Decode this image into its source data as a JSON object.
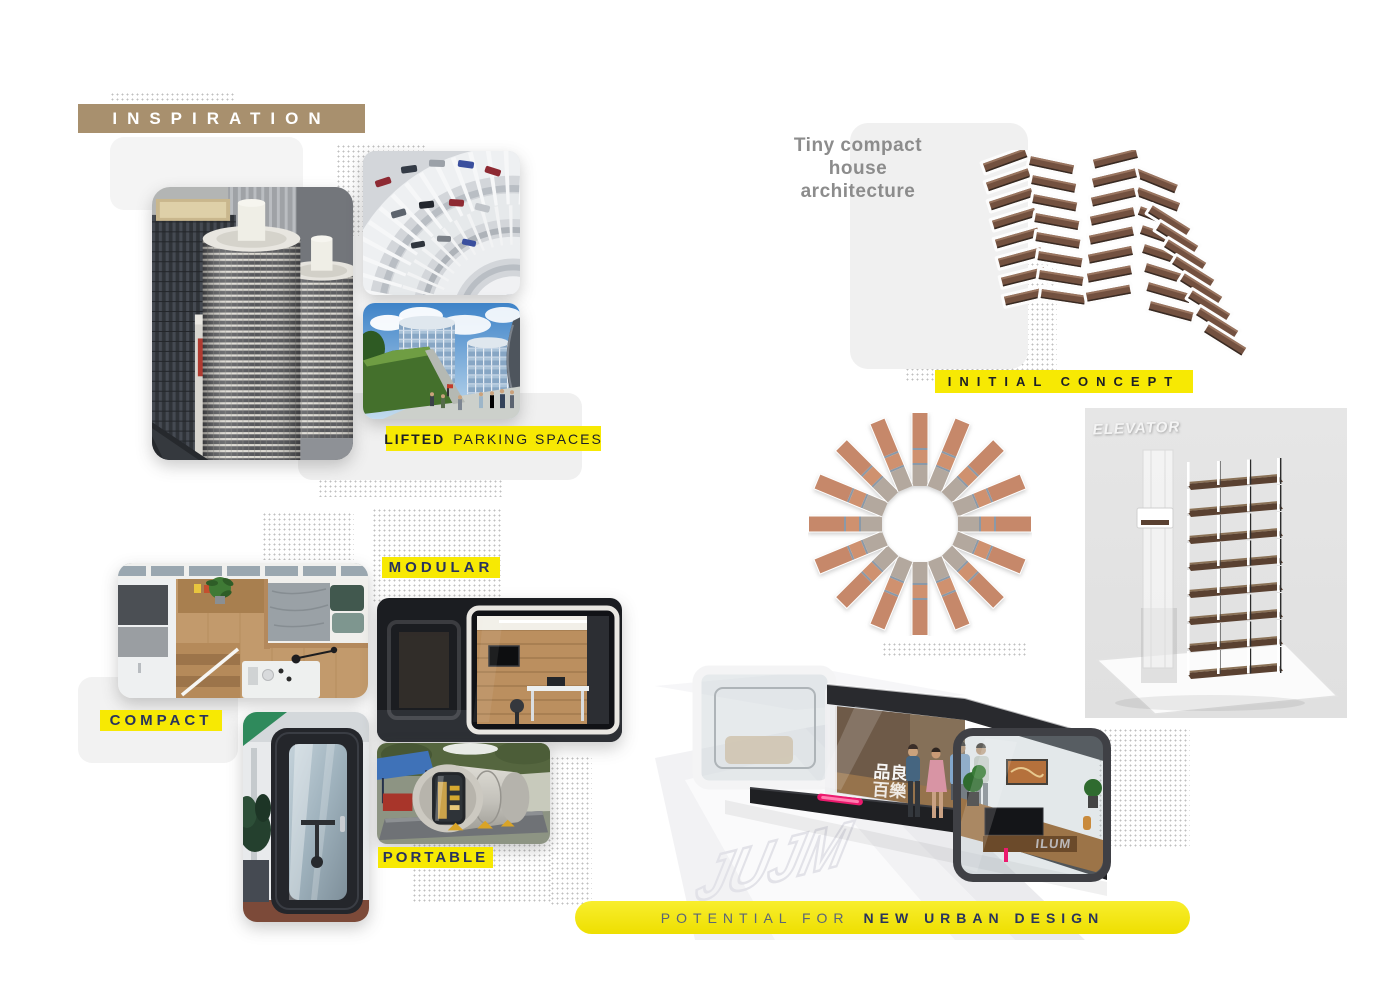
{
  "page": {
    "width": 1400,
    "height": 991,
    "background": "#ffffff"
  },
  "palette": {
    "yellow": "#f7e903",
    "tan": "#a8906e",
    "navy": "#28335c",
    "ink": "#1d2026",
    "note_gray": "#8c8c8c",
    "magenta": "#ec1a6e"
  },
  "inspiration": {
    "title": "INSPIRATION",
    "lifted_bold": "LIFTED",
    "lifted_rest": "PARKING SPACES"
  },
  "typologies": {
    "compact": "COMPACT",
    "modular": "MODULAR",
    "portable": "PORTABLE"
  },
  "concept": {
    "note_line1": "Tiny compact",
    "note_line2": "house",
    "note_line3": "architecture",
    "initial_concept": "INITIAL CONCEPT",
    "elevator": "ELEVATOR"
  },
  "urban": {
    "banner_light": "POTENTIAL FOR",
    "banner_bold": "NEW URBAN DESIGN",
    "cjk_line1": "品良",
    "cjk_line2": "百樂",
    "brand": "ILUM",
    "watermark": "JUJM"
  }
}
